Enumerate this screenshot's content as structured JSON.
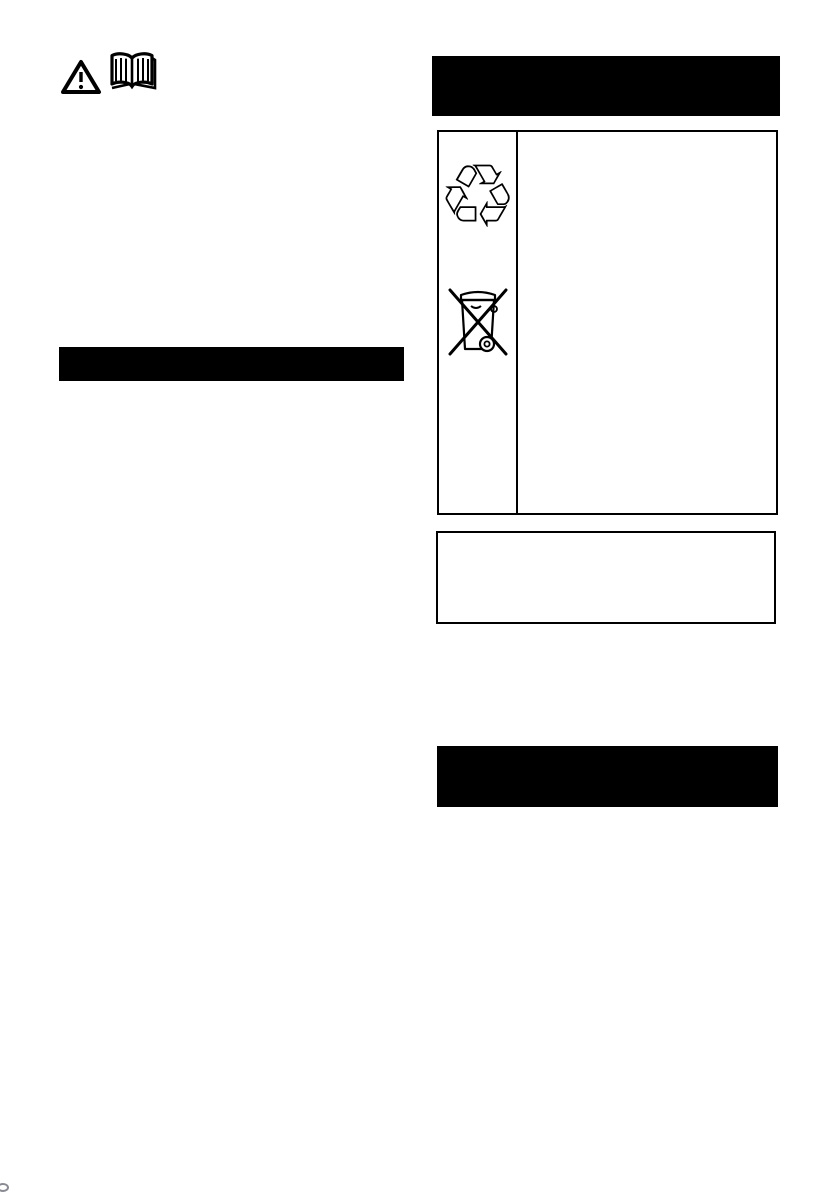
{
  "document": {
    "kind": "instruction-manual page (scanned, text not legible)",
    "background_color": "#ffffff",
    "ink_color": "#000000"
  },
  "left_column": {
    "header_icons": [
      {
        "icon": "warning-triangle-icon",
        "meaning": "warning / caution"
      },
      {
        "icon": "open-book-icon",
        "meaning": "read the instruction manual"
      }
    ],
    "section_bar": {
      "label": "",
      "fill": "#000000"
    }
  },
  "right_column": {
    "section_bar_top": {
      "label": "",
      "fill": "#000000"
    },
    "symbols_table": {
      "rows": [
        {
          "icon": "recycling-arrows-icon",
          "glyph": "♲",
          "description": ""
        },
        {
          "icon": "weee-crossed-out-bin-icon",
          "description": ""
        }
      ]
    },
    "note_box": {
      "text": ""
    },
    "section_bar_bottom": {
      "label": "",
      "fill": "#000000"
    }
  },
  "artifacts": {
    "corner_speck": "small scan mark, bottom-left corner"
  }
}
